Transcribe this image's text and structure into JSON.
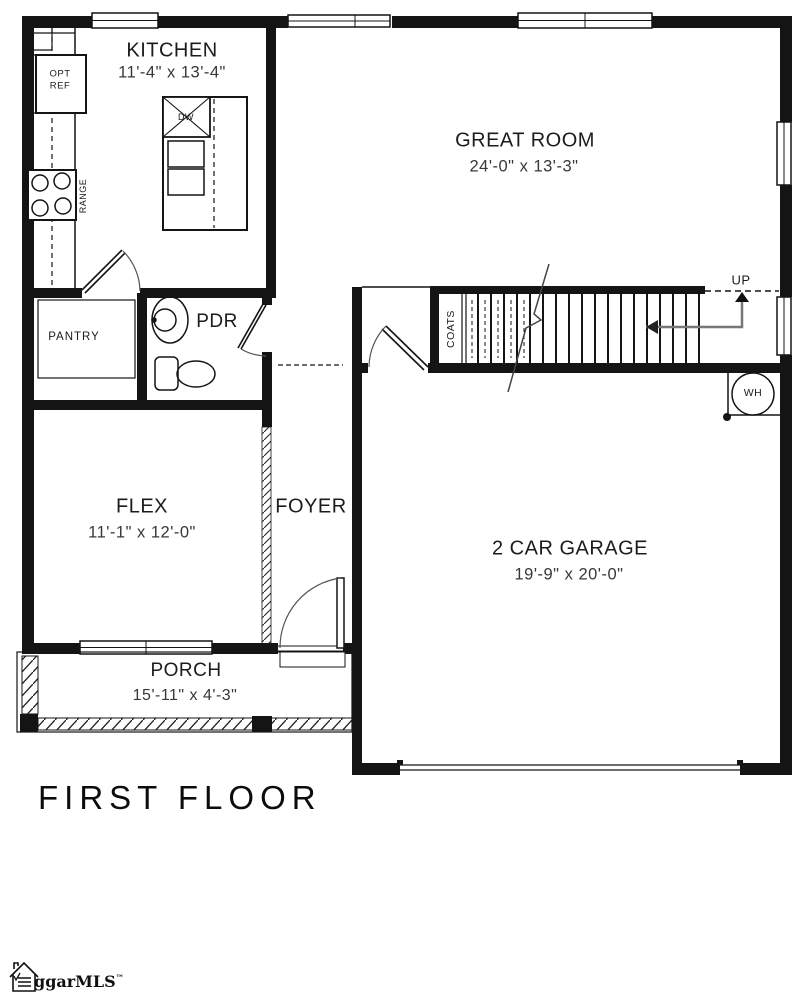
{
  "title": "FIRST FLOOR",
  "watermark": {
    "brand": "ggarMLS",
    "tm": "™"
  },
  "rooms": {
    "kitchen": {
      "name": "KITCHEN",
      "dims": "11'-4\" x 13'-4\""
    },
    "great_room": {
      "name": "GREAT ROOM",
      "dims": "24'-0\" x 13'-3\""
    },
    "pantry": {
      "name": "PANTRY"
    },
    "powder": {
      "name": "PDR"
    },
    "flex": {
      "name": "FLEX",
      "dims": "11'-1\" x 12'-0\""
    },
    "foyer": {
      "name": "FOYER"
    },
    "garage": {
      "name": "2 CAR GARAGE",
      "dims": "19'-9\" x 20'-0\""
    },
    "porch": {
      "name": "PORCH",
      "dims": "15'-11\" x 4'-3\""
    }
  },
  "fixtures": {
    "opt_ref_line1": "OPT",
    "opt_ref_line2": "REF",
    "range": "RANGE",
    "dishwasher": "DW",
    "coats_closet": "COATS",
    "water_heater": "WH",
    "stairs_direction": "UP"
  },
  "colors": {
    "wall": "#141414",
    "dim_text": "#383838",
    "arrow_line": "#777777"
  }
}
